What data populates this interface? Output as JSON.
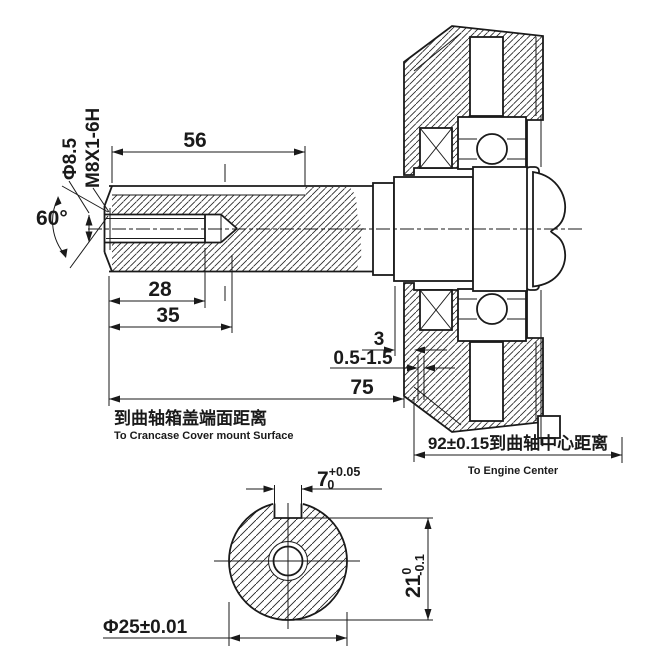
{
  "drawing": {
    "colors": {
      "line": "#1a1a1a",
      "background": "#ffffff"
    },
    "side_view": {
      "keyway_length": "56",
      "thread_depth": "28",
      "hole_depth": "35",
      "shaft_length": "75",
      "cover_gap": "3",
      "clearance": "0.5-1.5",
      "hole_label": "Φ8.5",
      "thread_label": "M8X1-6H",
      "chamfer_angle": "60°",
      "shaft_length_note_cn": "到曲轴箱盖端面距离",
      "shaft_length_note_en": "To Crancase Cover mount Surface",
      "engine_center_dim": "92±0.15到曲轴中心距离",
      "engine_center_note_en": "To Engine Center"
    },
    "end_view": {
      "keyway_width": "7",
      "keyway_width_tol_upper": "+0.05",
      "keyway_width_tol_lower": "0",
      "keyway_height": "21",
      "keyway_height_tol_upper": "0",
      "keyway_height_tol_lower": "-0.1",
      "shaft_diameter": "Φ25±0.01"
    }
  }
}
